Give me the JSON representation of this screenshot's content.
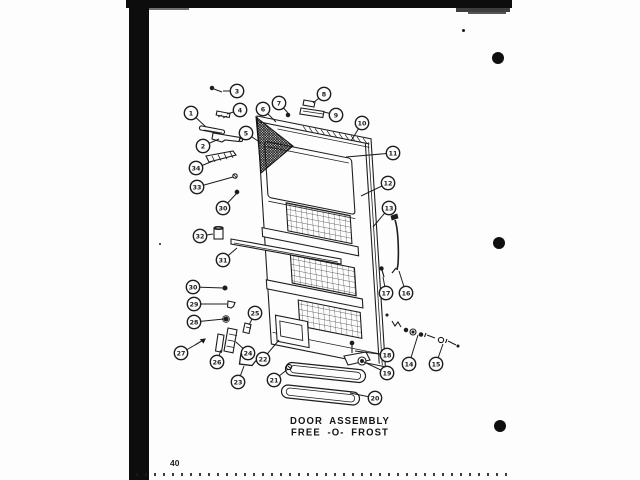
{
  "page": {
    "number": "40",
    "punch_holes": [
      {
        "cx": 498,
        "cy": 58,
        "r": 6
      },
      {
        "cx": 499,
        "cy": 243,
        "r": 6
      },
      {
        "cx": 500,
        "cy": 426,
        "r": 6
      }
    ]
  },
  "caption": {
    "line1": "DOOR ASSEMBLY",
    "line2": "FREE -O- FROST"
  },
  "colors": {
    "ink": "#1d1d1d",
    "paper": "#fdfdfd"
  },
  "diagram": {
    "subject": "refrigerator-door-exploded-view",
    "callouts": [
      {
        "label": "3",
        "cx": 237,
        "cy": 91,
        "tx": 223,
        "ty": 91
      },
      {
        "label": "1",
        "cx": 191,
        "cy": 113,
        "tx": 206,
        "ty": 127
      },
      {
        "label": "4",
        "cx": 240,
        "cy": 110,
        "tx": 227,
        "ty": 114
      },
      {
        "label": "2",
        "cx": 203,
        "cy": 146,
        "tx": 219,
        "ty": 139
      },
      {
        "label": "34",
        "cx": 196,
        "cy": 168,
        "tx": 213,
        "ty": 161
      },
      {
        "label": "33",
        "cx": 197,
        "cy": 187,
        "tx": 233,
        "ty": 177
      },
      {
        "label": "30",
        "cx": 223,
        "cy": 208,
        "tx": 237,
        "ty": 193
      },
      {
        "label": "32",
        "cx": 200,
        "cy": 236,
        "tx": 213,
        "ty": 234
      },
      {
        "label": "31",
        "cx": 223,
        "cy": 260,
        "tx": 237,
        "ty": 248
      },
      {
        "label": "30",
        "cx": 193,
        "cy": 287,
        "tx": 224,
        "ty": 288
      },
      {
        "label": "29",
        "cx": 194,
        "cy": 304,
        "tx": 227,
        "ty": 304
      },
      {
        "label": "28",
        "cx": 194,
        "cy": 322,
        "tx": 224,
        "ty": 319
      },
      {
        "label": "25",
        "cx": 255,
        "cy": 313,
        "tx": 249,
        "ty": 325
      },
      {
        "label": "27",
        "cx": 181,
        "cy": 353,
        "tx": 195,
        "ty": 345
      },
      {
        "label": "26",
        "cx": 217,
        "cy": 362,
        "tx": 221,
        "ty": 350
      },
      {
        "label": "24",
        "cx": 248,
        "cy": 353,
        "tx": 236,
        "ty": 342
      },
      {
        "label": "23",
        "cx": 238,
        "cy": 382,
        "tx": 244,
        "ty": 366
      },
      {
        "label": "22",
        "cx": 263,
        "cy": 359,
        "tx": 279,
        "ty": 340
      },
      {
        "label": "21",
        "cx": 274,
        "cy": 380,
        "tx": 288,
        "ty": 369
      },
      {
        "label": "20",
        "cx": 375,
        "cy": 398,
        "tx": 350,
        "ty": 393
      },
      {
        "label": "19",
        "cx": 387,
        "cy": 373,
        "tx": 364,
        "ty": 362
      },
      {
        "label": "18",
        "cx": 387,
        "cy": 355,
        "tx": 355,
        "ty": 351
      },
      {
        "label": "17",
        "cx": 386,
        "cy": 293,
        "tx": 383,
        "ty": 277
      },
      {
        "label": "16",
        "cx": 406,
        "cy": 293,
        "tx": 399,
        "ty": 271
      },
      {
        "label": "14",
        "cx": 409,
        "cy": 364,
        "tx": 418,
        "ty": 335
      },
      {
        "label": "15",
        "cx": 436,
        "cy": 364,
        "tx": 443,
        "ty": 344
      },
      {
        "label": "13",
        "cx": 389,
        "cy": 208,
        "tx": 373,
        "ty": 227
      },
      {
        "label": "12",
        "cx": 388,
        "cy": 183,
        "tx": 361,
        "ty": 196
      },
      {
        "label": "11",
        "cx": 393,
        "cy": 153,
        "tx": 346,
        "ty": 157
      },
      {
        "label": "10",
        "cx": 362,
        "cy": 123,
        "tx": 351,
        "ty": 141
      },
      {
        "label": "7",
        "cx": 279,
        "cy": 103,
        "tx": 288,
        "ty": 113
      },
      {
        "label": "8",
        "cx": 324,
        "cy": 94,
        "tx": 313,
        "ty": 103
      },
      {
        "label": "9",
        "cx": 336,
        "cy": 115,
        "tx": 324,
        "ty": 112
      },
      {
        "label": "6",
        "cx": 263,
        "cy": 109,
        "tx": 276,
        "ty": 122
      },
      {
        "label": "5",
        "cx": 246,
        "cy": 133,
        "tx": 261,
        "ty": 143
      }
    ]
  }
}
